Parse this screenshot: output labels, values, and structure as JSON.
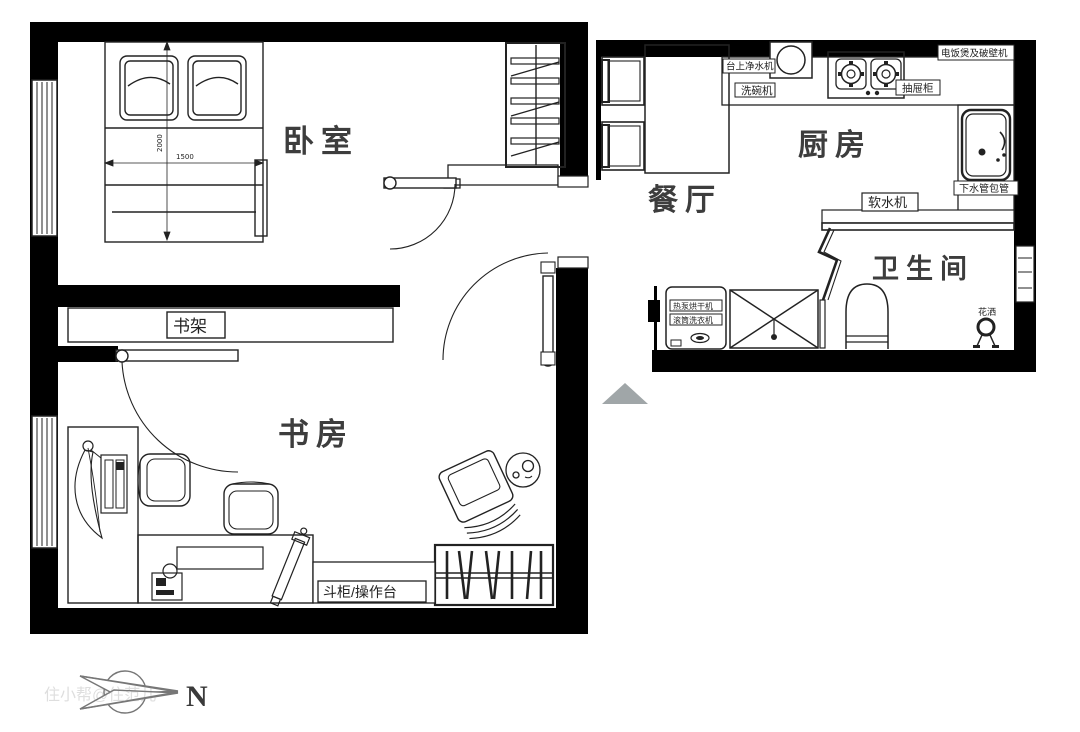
{
  "rooms": {
    "bedroom": {
      "label": "卧室"
    },
    "study": {
      "label": "书房"
    },
    "dining": {
      "label": "餐厅"
    },
    "kitchen": {
      "label": "厨房"
    },
    "bathroom": {
      "label": "卫生间"
    }
  },
  "annotations": {
    "bookshelf": "书架",
    "sideboard_worktop": "斗柜/操作台",
    "countertop_water_purifier": "台上净水机",
    "dishwasher": "洗碗机",
    "rice_cooker_and_blender": "电饭煲及破壁机",
    "drawer_cabinet": "抽屉柜",
    "water_softener": "软水机",
    "drain_pipe_boxing": "下水管包管",
    "shower_head": "花洒",
    "washer_line1": "热泵烘干机",
    "washer_line2": "滚筒洗衣机"
  },
  "dimensions": {
    "bed_width": "1500",
    "bed_length": "2000"
  },
  "compass": {
    "north": "N"
  },
  "watermark": {
    "text": "住小帮@住范儿"
  },
  "colors": {
    "wall": "#000000",
    "line": "#222222",
    "room_text": "#3d3d3d",
    "entry_arrow": "#a0a6a8",
    "watermark": "#8a8a8a"
  }
}
